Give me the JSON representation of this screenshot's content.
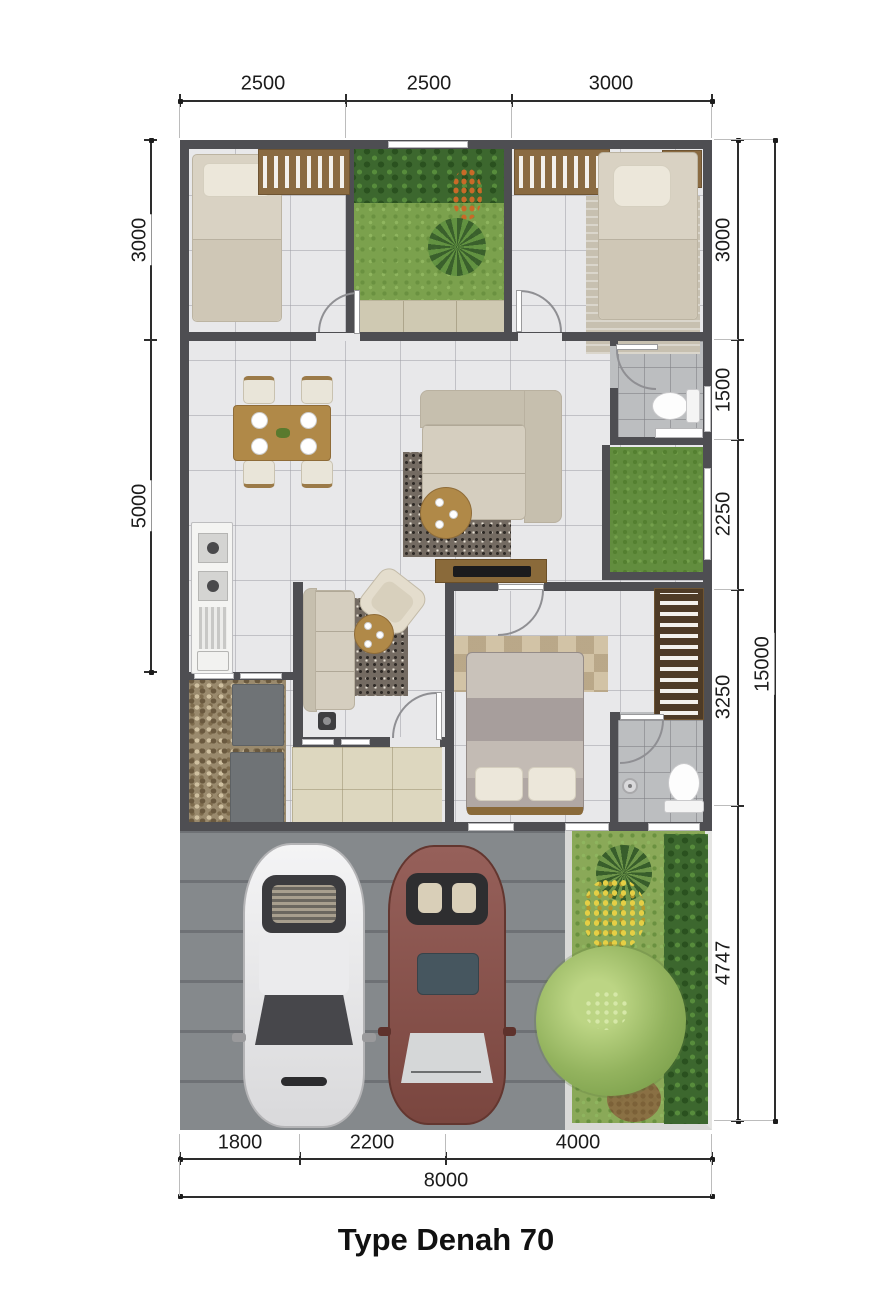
{
  "title": "Type Denah 70",
  "dimensions": {
    "top": [
      "2500",
      "2500",
      "3000"
    ],
    "left": [
      "3000",
      "5000"
    ],
    "right": [
      "3000",
      "1500",
      "2250",
      "3250",
      "4747"
    ],
    "right_total": "15000",
    "bottom": [
      "1800",
      "2200",
      "4000"
    ],
    "bottom_total": "8000"
  },
  "colors": {
    "wall": "#4e4e52",
    "floor": "#e8e8ea",
    "terrace": "#ddd7bf",
    "carport": "#85898c",
    "grass": "#7ba14d",
    "wood": "#b08948",
    "wardrobe": "#8a6b42",
    "car_white": "#ededee",
    "car_maroon": "#8e564e"
  }
}
